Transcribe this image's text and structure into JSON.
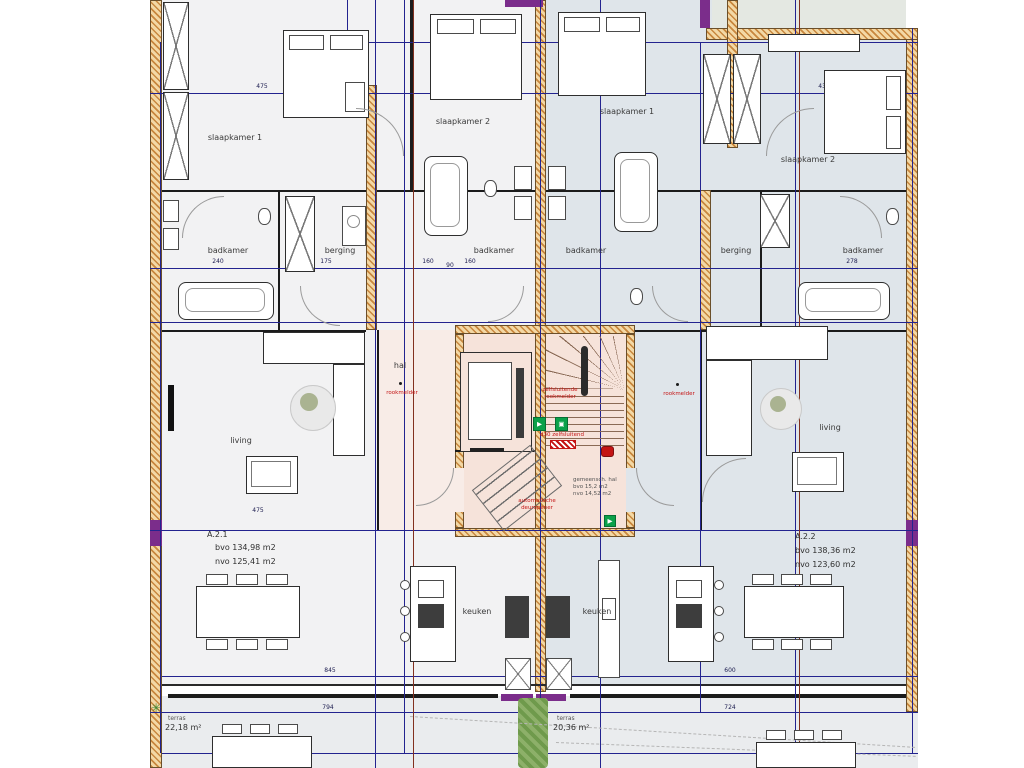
{
  "labels": {
    "slaapkamer1": "slaapkamer 1",
    "slaapkamer2": "slaapkamer 2",
    "badkamer": "badkamer",
    "berging": "berging",
    "living": "living",
    "keuken": "keuken",
    "hal": "hal",
    "terras": "terras",
    "rookmelder": "rookmelder"
  },
  "apartments": {
    "a21": {
      "id": "A.2.1",
      "bvo": "bvo 134,98 m2",
      "nvo": "nvo 125,41 m2"
    },
    "a22": {
      "id": "A.2.2",
      "bvo": "bvo 138,36 m2",
      "nvo": "nvo 123,60 m2"
    }
  },
  "core": {
    "zelfsluitende": "zelfsluitende",
    "rookmelder": "rookmelder",
    "automatische": "automatische",
    "deuropener": "deuropener",
    "d30": "d30 zelfsluitend",
    "gem1": "gemeensch. hal",
    "gem2": "bvo 15,2 m2",
    "gem3": "nvo 14,52 m2"
  },
  "terraces": {
    "left_area": "22,18 m²",
    "right_area": "20,36 m²"
  },
  "dimensions": {
    "top_left": "475",
    "top_mid": "300",
    "top_mid2": "45",
    "top_right": "435",
    "band": [
      "240",
      "175",
      "160",
      "90",
      "160",
      "278"
    ],
    "living_left": "475",
    "bottom_left": "845",
    "bottom_right": "600",
    "terras_left": "794",
    "terras_right": "724"
  },
  "colors": {
    "wall_hatch": "#c8873e",
    "dim_line": "#23238f",
    "ref_line": "#82301f",
    "apt_left_floor": "#f2f2f3",
    "apt_right_floor": "#dfe5ea",
    "core_floor": "#f6e3da",
    "exit_green": "#0ba14a",
    "annotation_red": "#c41414",
    "column_purple": "#7b2d8b"
  }
}
